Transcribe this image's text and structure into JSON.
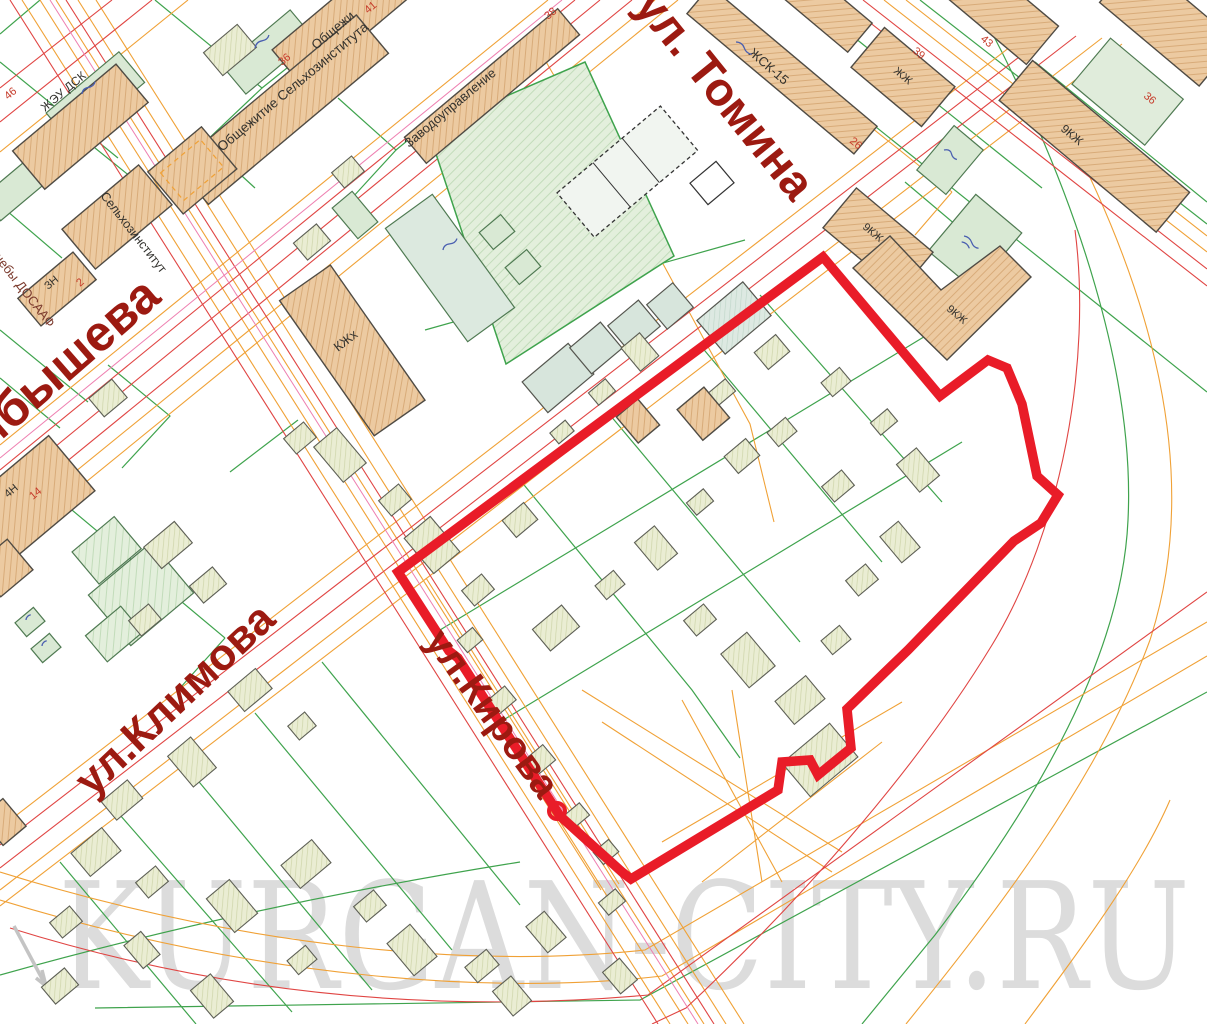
{
  "map": {
    "watermark": "KURGAN-CITY.RU",
    "streets": {
      "tomina": "ул. Томина",
      "kuibysheva": "ибышева",
      "klimova": "ул.Климова",
      "kirova": "ул.Кирова"
    },
    "buildings": [
      {
        "id": "dorm-top",
        "label": "Общежи",
        "number": "41"
      },
      {
        "id": "dorm-selkhoz",
        "label": "Общежитие Сельхозинститута",
        "number": "36"
      },
      {
        "id": "factory-office",
        "label": "Заводоуправление",
        "number": "38"
      },
      {
        "id": "zhsk-15",
        "label": "ЖСК-15",
        "number": "26"
      },
      {
        "id": "block-39",
        "label": "ЖЖ",
        "number": "39"
      },
      {
        "id": "block-43",
        "label": "",
        "number": "43"
      },
      {
        "id": "nine-storey-right",
        "label": "9КЖ",
        "number": "36"
      },
      {
        "id": "nine-storey-mid",
        "label": "9КЖ",
        "number": ""
      },
      {
        "id": "nine-storey-L",
        "label": "9КЖ",
        "number": ""
      },
      {
        "id": "zheu-dsk",
        "label": "ЖЭУ ДСК",
        "number": "46"
      },
      {
        "id": "selkhoz-institut",
        "label": "Сельхозинститут",
        "number": ""
      },
      {
        "id": "block-3n",
        "label": "ЗН",
        "number": "2"
      },
      {
        "id": "block-4n",
        "label": "4Н",
        "number": "14"
      },
      {
        "id": "kzh-h",
        "label": "КЖх",
        "number": ""
      },
      {
        "id": "dosaaf-area",
        "label": "чебы ДОСААФ",
        "number": ""
      }
    ],
    "colors": {
      "boundary": "#e91c28",
      "street_text": "#9c1a11",
      "parcel_line": "#3fa34d",
      "utility_orange": "#f0a136",
      "utility_red": "#e04543",
      "building_fill": "#eccaa1",
      "watermark": "#dcdcdc"
    }
  }
}
